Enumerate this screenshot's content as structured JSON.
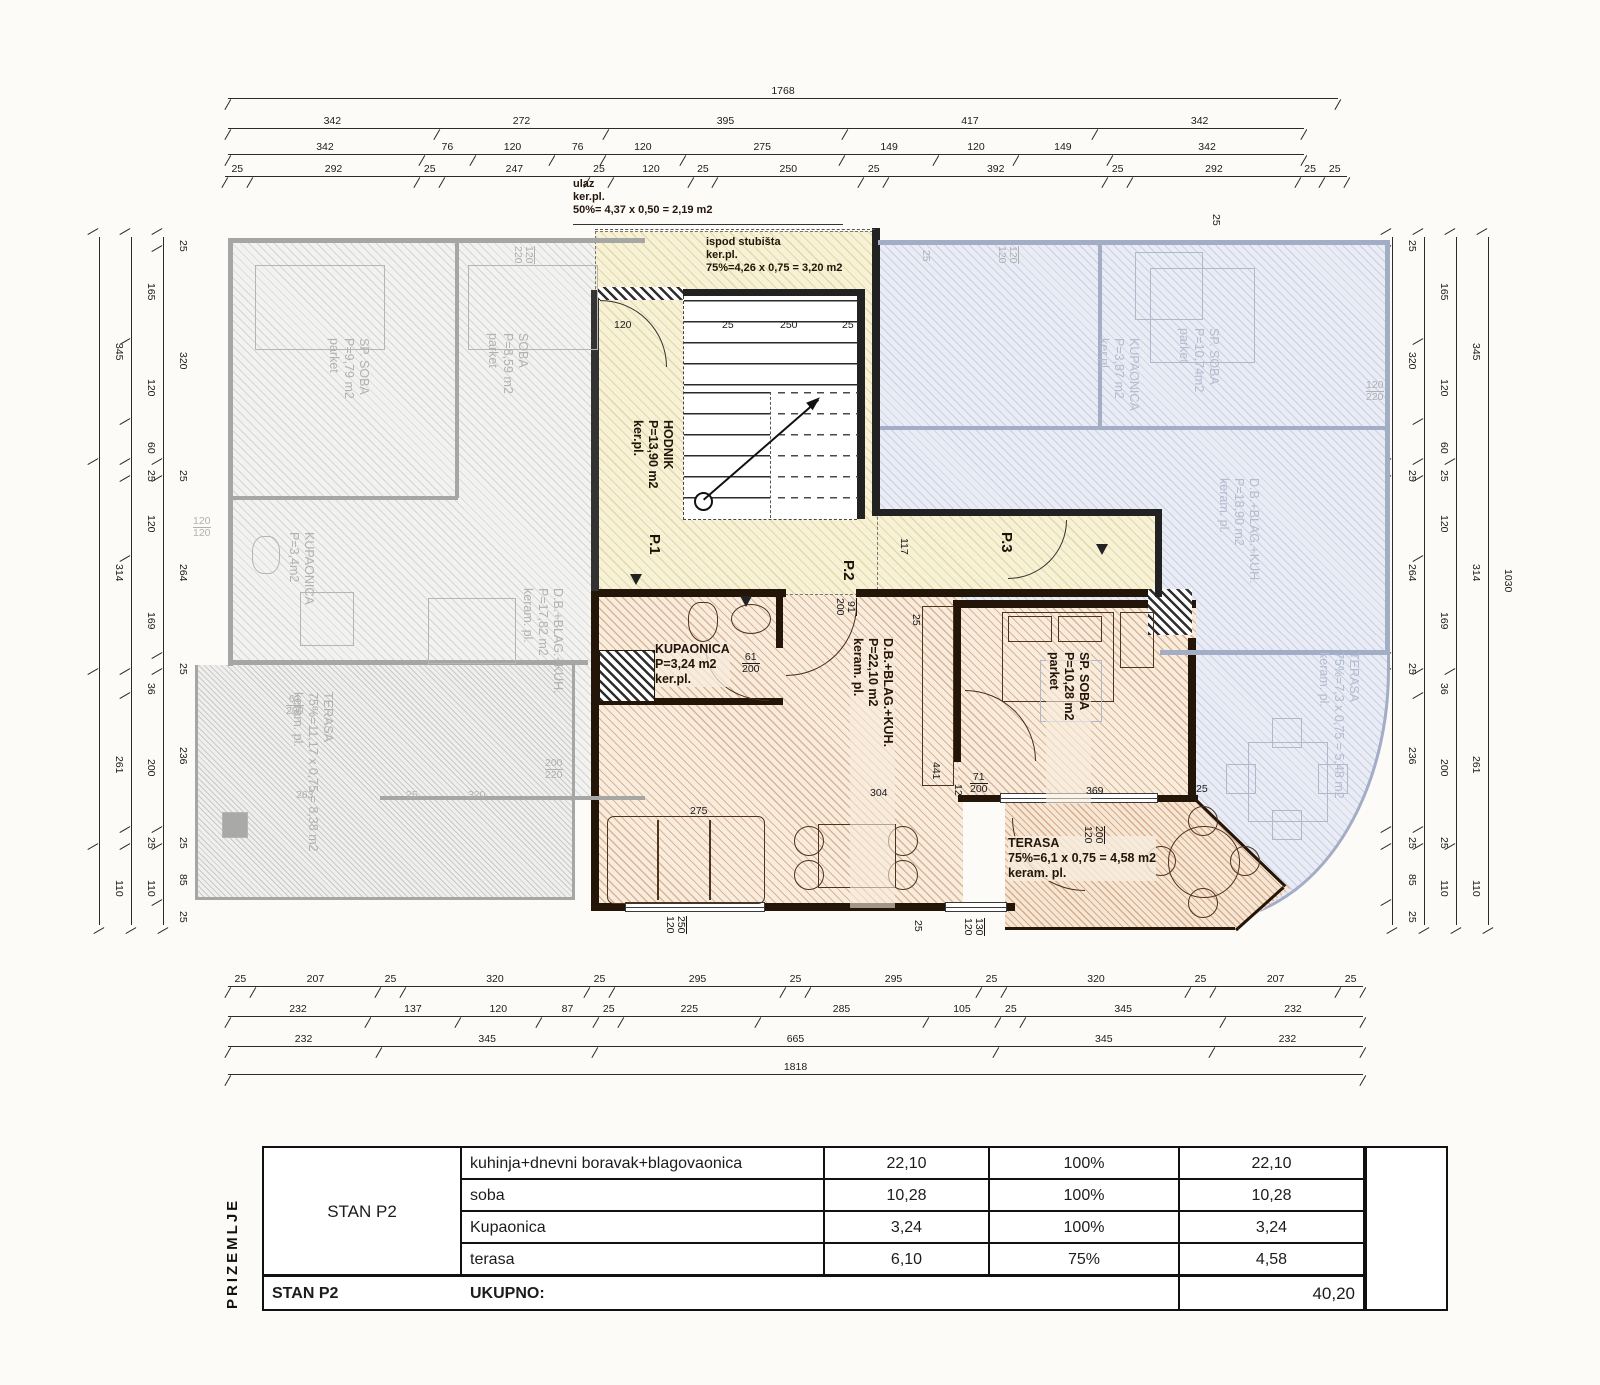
{
  "colors": {
    "orange_wall": "#241509",
    "yellow_bg": "#f6f1d7",
    "gray": "#b2b2b1",
    "blue": "#b4bccf",
    "ink": "#1c1c1c"
  },
  "top_dims": {
    "rows": [
      [
        "1768"
      ],
      [
        "342",
        "272",
        "395",
        "417",
        "342"
      ],
      [
        "342",
        "76",
        "120",
        "76",
        "120",
        "275",
        "149",
        "120",
        "149",
        "342"
      ],
      [
        "25",
        "292",
        "25",
        "247",
        "25",
        "120",
        "25",
        "250",
        "25",
        "392",
        "25",
        "292",
        "25",
        "25"
      ]
    ]
  },
  "bottom_dims": {
    "rows": [
      [
        "25",
        "207",
        "25",
        "320",
        "25",
        "295",
        "25",
        "295",
        "25",
        "320",
        "25",
        "207",
        "25"
      ],
      [
        "232",
        "137",
        "120",
        "87",
        "25",
        "225",
        "285",
        "105",
        "25",
        "345",
        "232"
      ],
      [
        "232",
        "345",
        "665",
        "345",
        "232"
      ],
      [
        "1818"
      ]
    ]
  },
  "left_dims": {
    "chains": [
      [
        "345",
        "314",
        "261",
        "110"
      ],
      [
        "165",
        "120",
        "60",
        "25",
        "120",
        "169",
        "36",
        "200",
        "25",
        "110"
      ],
      [
        "25",
        "320",
        "25",
        "264",
        "25",
        "236",
        "25",
        "85",
        "25"
      ]
    ]
  },
  "right_dims": {
    "chains": [
      [
        "25",
        "320",
        "25",
        "264",
        "25",
        "236",
        "25",
        "85",
        "25"
      ],
      [
        "165",
        "120",
        "60",
        "25",
        "120",
        "169",
        "36",
        "200",
        "25",
        "110"
      ],
      [
        "345",
        "314",
        "261",
        "110"
      ],
      [
        "1030"
      ]
    ]
  },
  "hall": {
    "ulaz": [
      "ulaz",
      "ker.pl.",
      "50%= 4,37 x 0,50 = 2,19 m2"
    ],
    "ispod": [
      "ispod stubišta",
      "ker.pl.",
      "75%=4,26 x 0,75 = 3,20 m2"
    ],
    "hodnik": [
      "HODNIK",
      "P=13,90 m2",
      "ker.pl."
    ],
    "stair_dims": [
      "25",
      "250",
      "25"
    ],
    "entries": [
      "P.1",
      "P.2",
      "P.3"
    ]
  },
  "stan_p2": {
    "kupaonica": [
      "KUPAONICA",
      "P=3,24 m2",
      "ker.pl."
    ],
    "living": [
      "D.B.+BLAG.+KUH.",
      "P=22,10 m2",
      "keram. pl."
    ],
    "soba": [
      "SP. SOBA",
      "P=10,28 m2",
      "parket"
    ],
    "terasa": [
      "TERASA",
      "75%=6,1 x 0,75 = 4,58 m2",
      "keram. pl."
    ]
  },
  "apt_left": {
    "sp_soba": [
      "SP. SOBA",
      "P=9,79 m2",
      "parket"
    ],
    "soba": [
      "SOBA",
      "P=8,59 m2",
      "parket"
    ],
    "kupaonica": [
      "KUPAONICA",
      "P=3,4m2"
    ],
    "living": [
      "D.B.+BLAG.+KUH.",
      "P=17,82 m2",
      "keram. pl."
    ],
    "terasa": [
      "TERASA",
      "75%=11,17 x 0,75 = 8,38 m2",
      "keram. pl."
    ]
  },
  "apt_right": {
    "sp_soba": [
      "SP. SOBA",
      "P=10,74m2",
      "parket"
    ],
    "kupaonica": [
      "KUPAONICA",
      "P=3,87 m2",
      "ker.pl."
    ],
    "living": [
      "D.B.+BLAG.+KUH.",
      "P=18,90 m2",
      "keram. pl."
    ],
    "terasa": [
      "TERASA",
      "75%=7,3 x 0,75 = 5,48 m2",
      "keram. pl."
    ]
  },
  "inner_dims": [
    {
      "t": "120",
      "x": 614,
      "y": 320
    },
    {
      "t": "25",
      "x": 722,
      "y": 320
    },
    {
      "t": "250",
      "x": 780,
      "y": 320
    },
    {
      "t": "25",
      "x": 842,
      "y": 320
    },
    {
      "t": "117",
      "x": 898,
      "y": 538,
      "v": true
    },
    {
      "t": "91|200",
      "x": 834,
      "y": 598,
      "v": true
    },
    {
      "t": "61|200",
      "x": 742,
      "y": 652
    },
    {
      "t": "25",
      "x": 910,
      "y": 614,
      "v": true
    },
    {
      "t": "304",
      "x": 870,
      "y": 788
    },
    {
      "t": "441",
      "x": 930,
      "y": 762,
      "v": true
    },
    {
      "t": "12",
      "x": 952,
      "y": 784,
      "v": true
    },
    {
      "t": "71|200",
      "x": 970,
      "y": 772
    },
    {
      "t": "275",
      "x": 690,
      "y": 806
    },
    {
      "t": "369",
      "x": 1086,
      "y": 786
    },
    {
      "t": "25",
      "x": 1196,
      "y": 784
    },
    {
      "t": "250|120",
      "x": 664,
      "y": 916,
      "v": true
    },
    {
      "t": "25",
      "x": 912,
      "y": 920,
      "v": true
    },
    {
      "t": "130|120",
      "x": 962,
      "y": 918,
      "v": true
    },
    {
      "t": "200|120",
      "x": 1082,
      "y": 826,
      "v": true
    },
    {
      "t": "25",
      "x": 1210,
      "y": 214,
      "v": true
    },
    {
      "t": "25",
      "x": 920,
      "y": 250,
      "v": true,
      "faded": true
    },
    {
      "t": "120|120",
      "x": 996,
      "y": 246,
      "v": true,
      "faded": true
    },
    {
      "t": "120|220",
      "x": 1366,
      "y": 380,
      "faded": true
    },
    {
      "t": "120|120",
      "x": 193,
      "y": 516,
      "faded": true
    },
    {
      "t": "120|220",
      "x": 512,
      "y": 246,
      "v": true,
      "faded": true
    },
    {
      "t": "200|220",
      "x": 545,
      "y": 758,
      "faded": true
    },
    {
      "t": "263",
      "x": 296,
      "y": 790,
      "faded": true
    },
    {
      "t": "25",
      "x": 406,
      "y": 790,
      "faded": true
    },
    {
      "t": "320",
      "x": 468,
      "y": 790,
      "faded": true
    },
    {
      "t": "61|200",
      "x": 286,
      "y": 694,
      "faded": true
    }
  ],
  "table": {
    "sidebar": "PRIZEMLJE",
    "group": "STAN P2",
    "rows": [
      [
        "kuhinja+dnevni boravak+blagovaonica",
        "22,10",
        "100%",
        "22,10"
      ],
      [
        "soba",
        "10,28",
        "100%",
        "10,28"
      ],
      [
        "Kupaonica",
        "3,24",
        "100%",
        "3,24"
      ],
      [
        "terasa",
        "6,10",
        "75%",
        "4,58"
      ]
    ],
    "footer": {
      "group": "STAN P2",
      "label": "UKUPNO:",
      "values": [
        "",
        "",
        ""
      ],
      "total": "40,20"
    }
  }
}
